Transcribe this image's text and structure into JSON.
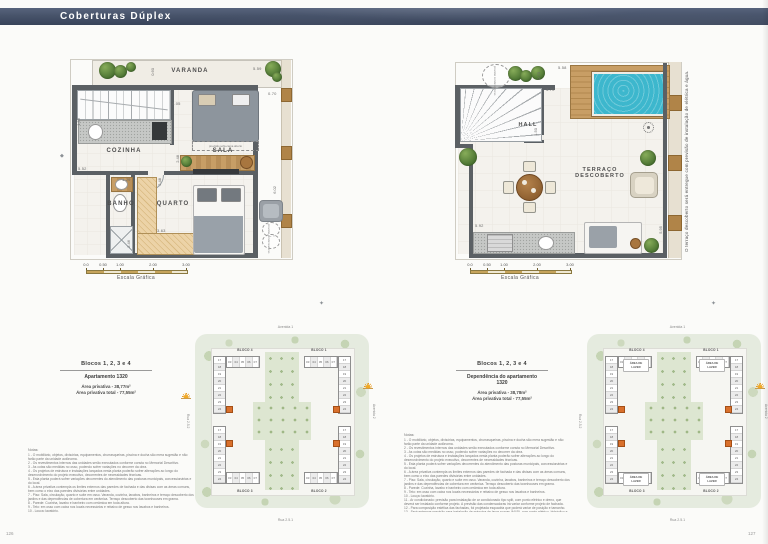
{
  "header": {
    "title": "Coberturas Dúplex"
  },
  "page_numbers": {
    "left": "126",
    "right": "127"
  },
  "icons": {
    "compass": "✦",
    "diamond": "◆"
  },
  "plan_lower": {
    "labels": {
      "varanda": "VARANDA",
      "cozinha": "COZINHA",
      "sala": "SALA",
      "banho": "BANHO",
      "quarto": "QUARTO"
    },
    "annotations": {
      "sofa": "previsão sofá-cama aberto",
      "condensadoras": "previsão condensadoras"
    },
    "dims": {
      "top_right": "5.59",
      "right_upper": "0.70",
      "varanda_depth": "0.60",
      "sala_width": "4.05",
      "kitchen_left": "1.59",
      "mid_left": "5.52",
      "banho_top": "1.29",
      "sala_bottom": "2.48",
      "quarto_top": "2.48",
      "quarto_bottom": "3.63",
      "banho_left": "2.46",
      "right_lower": "6.02"
    }
  },
  "plan_upper": {
    "labels": {
      "hall": "HALL",
      "terraco_line1": "TERRAÇO",
      "terraco_line2": "DESCOBERTO"
    },
    "annotations": {
      "condensadoras": "previsão condensadoras"
    },
    "dims": {
      "top": "5.58",
      "deck_left": "0.70",
      "hall_top": "3.70",
      "hall_right": "1.50",
      "bottom_left": "5.92",
      "right_lower": "5.95"
    },
    "side_note": "O terraço descoberto será entregue com previsão de instalação de elétrica e água."
  },
  "scalebar": {
    "ticks": [
      "0.0",
      "0.50",
      "1.00",
      "2.00",
      "3.00"
    ],
    "label": "Escala Gráfica"
  },
  "info_left": {
    "blocks": "Blocos 1, 2, 3 e 4",
    "unit": "Apartamento 1320",
    "area1": "Área privativa - 38,77m²",
    "area2": "Área privativa total - 77,55m²"
  },
  "info_right": {
    "blocks": "Blocos 1, 2, 3 e 4",
    "unit": "Dependência do apartamento 1320",
    "area1": "Área privativa - 38,78m²",
    "area2": "Área privativa total - 77,55m²"
  },
  "siteplan_left": {
    "street_top": "Avenida 1",
    "street_right": "Avenida 2",
    "street_left": "Rua 2.5.2",
    "street_bottom": "Rua 2.5.1",
    "block_tl": "BLOCO 4",
    "block_tr": "BLOCO 1",
    "block_bl": "BLOCO 3",
    "block_br": "BLOCO 2",
    "show_lazer": false,
    "sun_left": true
  },
  "siteplan_right": {
    "street_top": "Avenida 1",
    "street_right": "Avenida 2",
    "street_left": "Rua 2.5.2",
    "street_bottom": "Rua 2.5.1",
    "block_tl": "BLOCO 4",
    "block_tr": "BLOCO 1",
    "block_bl": "BLOCO 3",
    "block_br": "BLOCO 2",
    "show_lazer": true,
    "lazer": "ÁREA DE LAZER",
    "sun_left": false
  },
  "site_numbers": {
    "tower": [
      "17",
      "18",
      "19",
      "20",
      "21",
      "22",
      "23",
      "24"
    ],
    "slab": [
      "03",
      "04",
      "05",
      "06",
      "07"
    ]
  },
  "notes": {
    "title": "Notas:",
    "lines": [
      "1 - O mobiliário, objetos, divisórias, equipamentos, churrasqueiras, piscina e ducha são mera sugestão e não farão parte da unidade autônoma.",
      "2 - Os revestimentos internos das unidades serão executados conforme consta no Memorial Descritivo.",
      "3 - As cotas são medidas no osso, podendo sofrer variações no decorrer da obra.",
      "4 - Os projetos de estrutura e instalações lançados nesta planta poderão sofrer alterações ao longo do desenvolvimento do projeto executivo, decorrentes de necessidades técnicas.",
      "5 - Esta planta poderá sofrer variações decorrentes do atendimento das posturas municipais, concessionárias e do local.",
      "6 - A área privativa contempla os limites externos das paredes de fachada e das divisas com as áreas comuns, bem como o eixo das paredes divisórias entre unidades.",
      "7 - Piso: Sala, circulação, quarto e suíte em osso. Varanda, cozinha, lavabos, banheiros e terraço descoberto dos jardins e das dependências de cobertura em cerâmica. Terraço descoberto das townhouses em grama.",
      "8 - Parede: Cozinha, lavabo e banheiro com cerâmica em toda altura.",
      "9 - Teto: em osso com caixa nos locais necessários e rebaixo de gesso nos lavabos e banheiros.",
      "10 - Louça: lavatório.",
      "11 - Ar condicionado: previsão para instalação de ar condicionado tipo split, com ponto elétrico e dreno, que deverá ser instalado conforme projeto. A previsão das condensadoras irá variar conforme projeto de fachada.",
      "12 - Para composição estética das fachadas, foi projetada esquadria que poderá variar de posição e tamanho.",
      "13 - Será entregue previsão para instalação de máquina de lavar roupas (MLR), com ponto elétrico, hidráulico e esgoto.",
      "14 - A unidade será entregue com ponto para instalação de cooktop elétrico, não havendo viabilidade para instalação de gás."
    ]
  },
  "colors": {
    "header": "#47536a",
    "accent_orange": "#d9702c",
    "pool": "#3db7cd",
    "wood": "#c79e66",
    "wall": "#5b6064",
    "site_green": "#e5ebdf"
  }
}
